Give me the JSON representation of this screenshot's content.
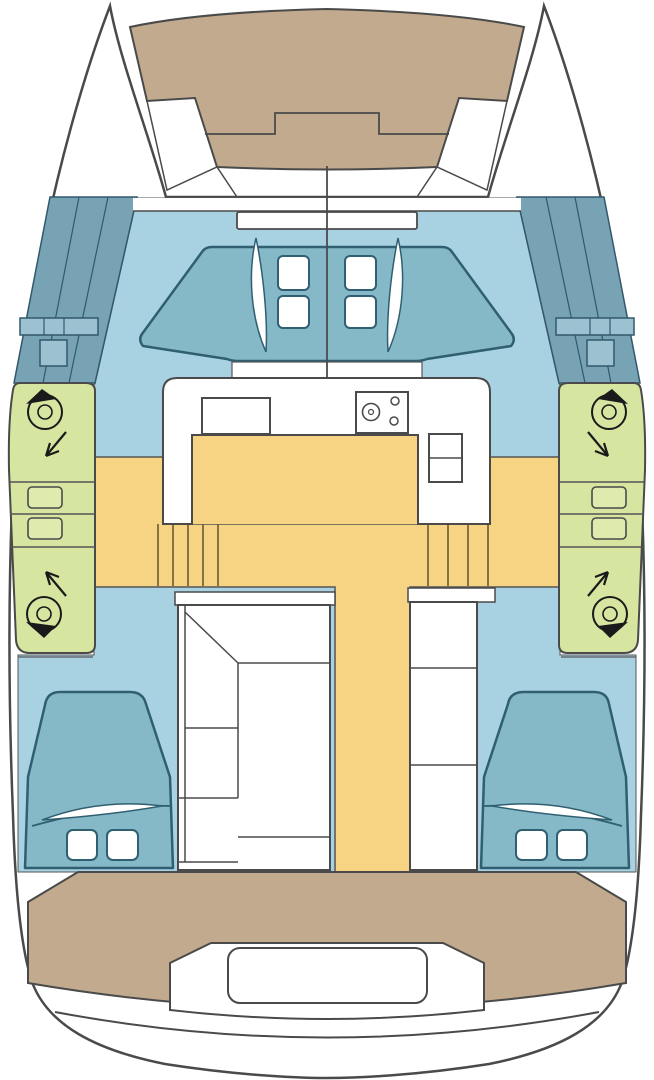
{
  "plan": {
    "title": "Catamaran deck layout plan (top view)",
    "type": "boat-floor-plan",
    "regions": [
      {
        "id": "foredeck",
        "label": "foredeck-sunpad"
      },
      {
        "id": "forward-berth",
        "label": "forward-berth-lounge"
      },
      {
        "id": "port-side-deck",
        "label": "port-side-deck"
      },
      {
        "id": "starboard-side-deck",
        "label": "starboard-side-deck"
      },
      {
        "id": "galley",
        "label": "galley-counter"
      },
      {
        "id": "saloon",
        "label": "saloon-floor"
      },
      {
        "id": "port-head",
        "label": "port-head-compartment"
      },
      {
        "id": "starboard-head",
        "label": "starboard-head-compartment"
      },
      {
        "id": "port-aft-cabin",
        "label": "port-aft-cabin-berth"
      },
      {
        "id": "starboard-aft-cabin",
        "label": "starboard-aft-cabin-berth"
      },
      {
        "id": "aft-cockpit",
        "label": "aft-cockpit-deck"
      },
      {
        "id": "aft-bench",
        "label": "aft-cockpit-bench"
      }
    ],
    "features": {
      "forward_hatches": 4,
      "winches": 4,
      "deck_windows_per_side": 2,
      "companionway_steps": 2,
      "aft_berths": 2,
      "pillows_per_berth": 2,
      "stove_burners": 3
    }
  },
  "colors": {
    "white": "#ffffff",
    "outline": "#4a4a4a",
    "detail": "#555555",
    "deck_tan": "#c1aa8d",
    "floor_blue": "#a8d2e2",
    "furniture_teal": "#86b9c8",
    "teal_stroke": "#2f5f70",
    "sidedeck_teal": "#78a3b5",
    "sidedeck_line": "#31596b",
    "sidedeck_hatch": "#9cc2d1",
    "deck_green": "#d6e5a0",
    "green_window": "#dfeaae",
    "floor_yellow": "#f7d384",
    "step_line": "#6b5a33",
    "black": "#1a1a1a"
  }
}
